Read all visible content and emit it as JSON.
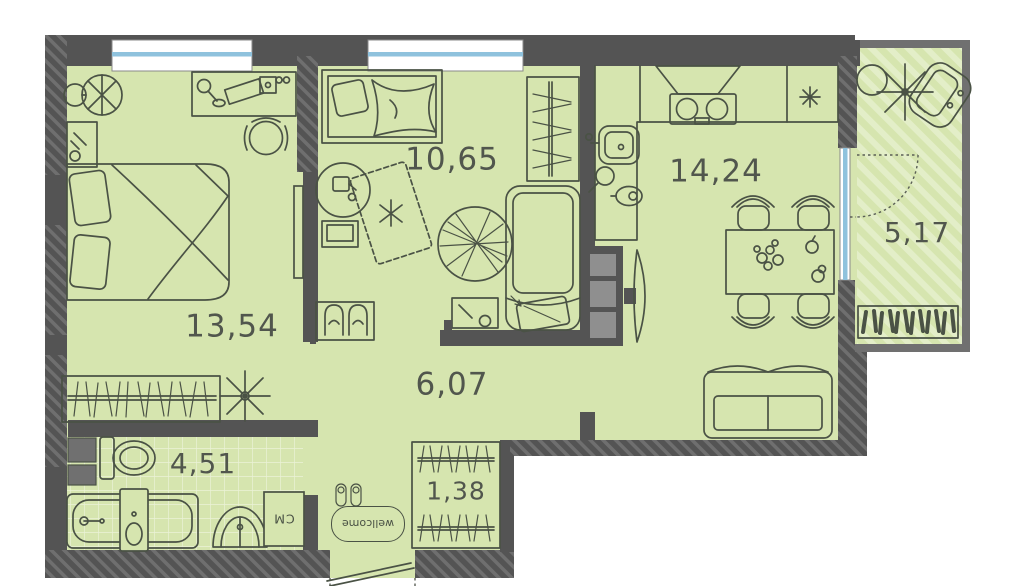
{
  "plan": {
    "rooms": [
      {
        "name": "bedroom",
        "area": "13,54"
      },
      {
        "name": "bedroom-2",
        "area": "10,65"
      },
      {
        "name": "kitchen-living-room",
        "area": "14,24"
      },
      {
        "name": "balcony",
        "area": "5,17"
      },
      {
        "name": "hallway",
        "area": "6,07"
      },
      {
        "name": "bathroom",
        "area": "4,51"
      },
      {
        "name": "wardrobe",
        "area": "1,38"
      }
    ],
    "labels": {
      "washer_box": "СМ",
      "doormat": "wellcome"
    },
    "colors": {
      "floor": "#d6e5af",
      "floor_stripe": "#e3eec8",
      "wall": "#545454",
      "wall_hatch": "#6f6f6f",
      "balcony_wall": "#707070",
      "glass": "#8fc2dd",
      "line": "#4a5245",
      "appliance": "#8f8f8f",
      "text": "#51564d"
    }
  }
}
